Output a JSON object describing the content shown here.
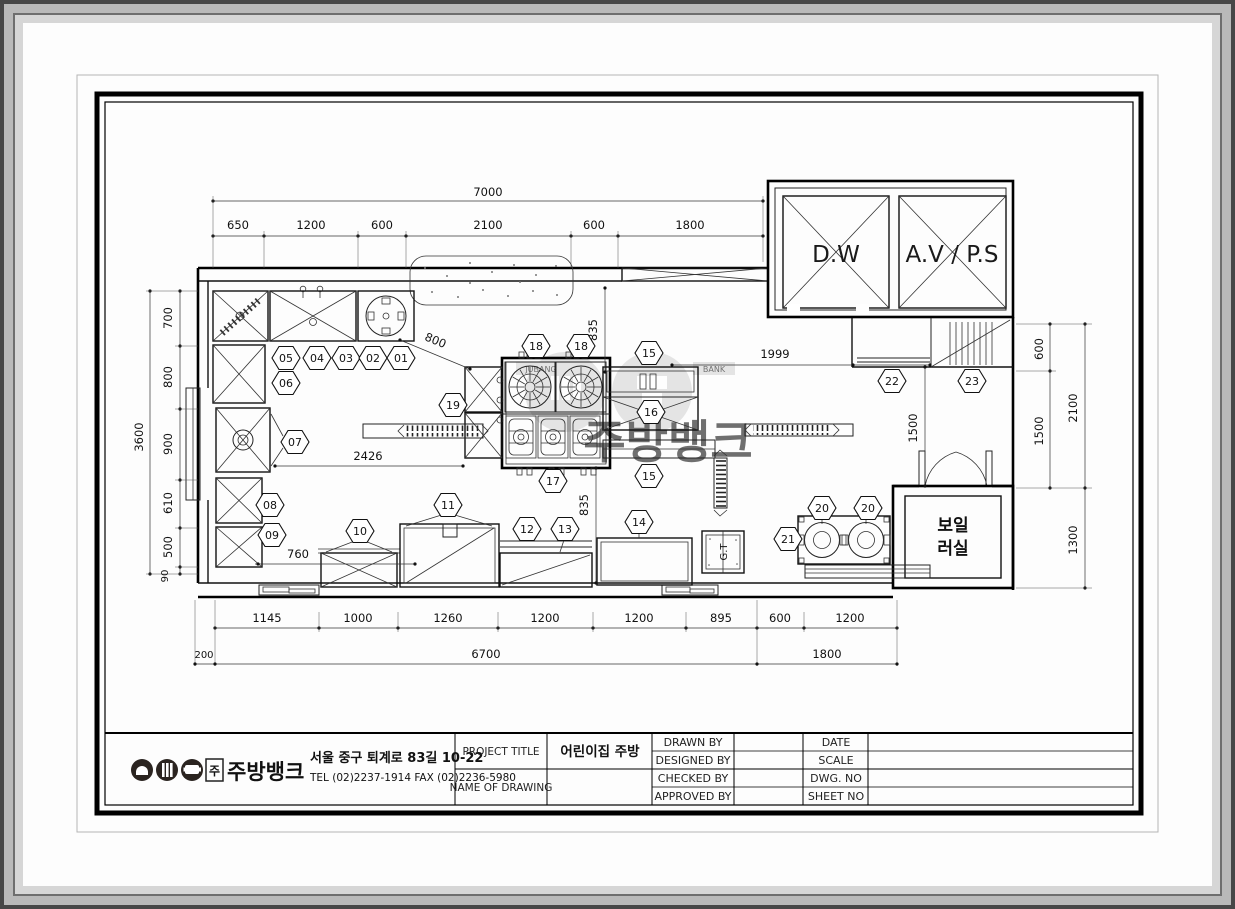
{
  "watermark": {
    "jubang": "JUBANG",
    "bank": "BANK",
    "korean": "주방뱅크"
  },
  "plan": {
    "rooms": {
      "dw": "D.W",
      "avps": "A.V / P.S",
      "boiler1": "보일",
      "boiler2": "러실",
      "grease_trap": "G.T"
    },
    "tag_instances": [
      "05",
      "04",
      "03",
      "02",
      "01",
      "06",
      "07",
      "08",
      "09",
      "10",
      "11",
      "12",
      "13",
      "14",
      "18",
      "18",
      "15",
      "16",
      "15",
      "17",
      "19",
      "20",
      "20",
      "21",
      "22",
      "23"
    ],
    "dims": {
      "top_total": "7000",
      "top": [
        "650",
        "1200",
        "600",
        "2100",
        "600",
        "1800"
      ],
      "left_total": "3600",
      "left": [
        "700",
        "800",
        "900",
        "610",
        "500",
        "90"
      ],
      "bottom": [
        "1145",
        "1000",
        "1260",
        "1200",
        "1200",
        "895",
        "600",
        "1200"
      ],
      "bottom2": [
        "200",
        "6700",
        "1800"
      ],
      "right": [
        "600",
        "1500",
        "2100",
        "1300"
      ],
      "inner": {
        "a": "1999",
        "b": "2426",
        "c": "800",
        "d": "760",
        "e": "835",
        "f": "835",
        "g": "1500"
      }
    }
  },
  "title_block": {
    "company": {
      "mark": "주",
      "name": "주방뱅크",
      "address": "서울 중구 퇴계로 83길 10-22",
      "tel": "TEL (02)2237-1914 FAX (02)2236-5980"
    },
    "project_title_label": "PROJECT TITLE",
    "project_title_value": "어린이집 주방",
    "name_of_drawing_label": "NAME OF DRAWING",
    "drawn_by": "DRAWN BY",
    "designed_by": "DESIGNED BY",
    "checked_by": "CHECKED BY",
    "approved_by": "APPROVED BY",
    "date": "DATE",
    "scale": "SCALE",
    "dwg_no": "DWG. NO",
    "sheet_no": "SHEET NO"
  }
}
